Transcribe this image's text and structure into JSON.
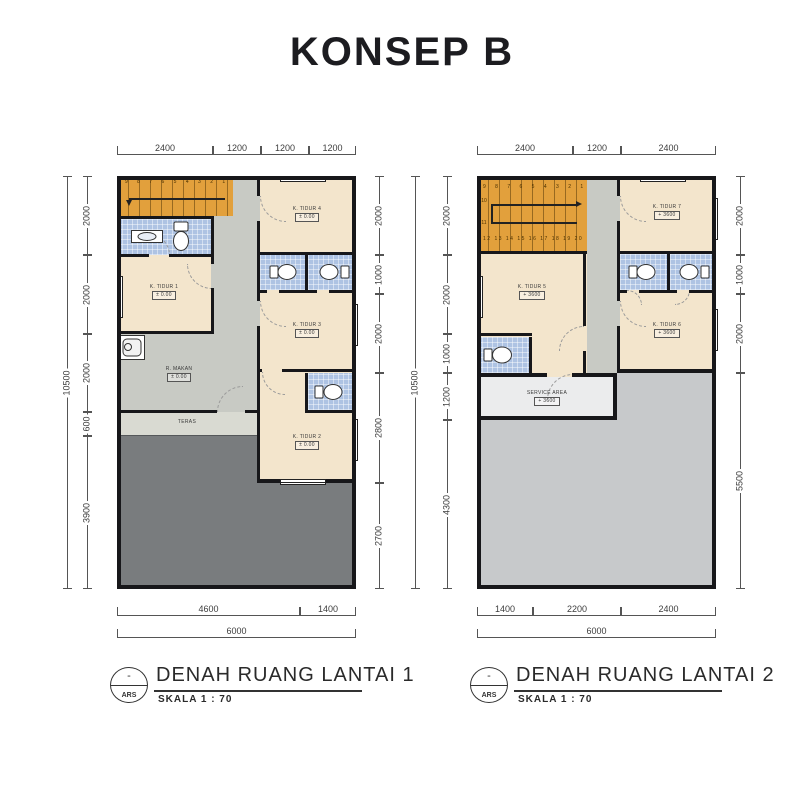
{
  "title": "KONSEP B",
  "colors": {
    "wall": "#17171a",
    "stair_orange": "#e2a03c",
    "bathroom_blue": "#aec3e3",
    "room_cream": "#f3e5cc",
    "corridor_grey": "#c8cac4",
    "teras_grey": "#d9dad2",
    "yard_dark_grey": "#797c7e",
    "roof_grey": "#c7c9cb",
    "service_white": "#ebeced"
  },
  "plans": [
    {
      "caption": {
        "title": "DENAH RUANG LANTAI 1",
        "scale": "SKALA 1 : 70",
        "tag_top": "-",
        "tag_bottom": "ARS"
      },
      "stair": {
        "numbers": "9 8 7 6 5 4 3 2 1"
      },
      "rooms": {
        "k_tidur_1": {
          "name": "K. TIDUR 1",
          "elev": "± 0.00"
        },
        "k_tidur_2": {
          "name": "K. TIDUR 2",
          "elev": "± 0.00"
        },
        "k_tidur_3": {
          "name": "K. TIDUR 3",
          "elev": "± 0.00"
        },
        "k_tidur_4": {
          "name": "K. TIDUR 4",
          "elev": "± 0.00"
        },
        "r_makan": {
          "name": "R. MAKAN",
          "elev": "± 0.00"
        },
        "teras": {
          "name": "TERAS"
        }
      },
      "dims": {
        "top": [
          "2400",
          "1200",
          "1200",
          "1200"
        ],
        "left_total": "10500",
        "left": [
          "2000",
          "2000",
          "2000",
          "600",
          "3900"
        ],
        "right": [
          "2000",
          "1000",
          "2000",
          "2800",
          "2700"
        ],
        "bottom": [
          "4600",
          "1400"
        ],
        "bottom_total": "6000"
      }
    },
    {
      "caption": {
        "title": "DENAH RUANG LANTAI 2",
        "scale": "SKALA 1 : 70",
        "tag_top": "-",
        "tag_bottom": "ARS"
      },
      "stair": {
        "numbers_upper": "9 8 7 6 5 4 3 2 1",
        "numbers_lower": "12 13 14 15 16 17 18 19 20",
        "landing_a": "10",
        "landing_b": "11"
      },
      "rooms": {
        "k_tidur_5": {
          "name": "K. TIDUR 5",
          "elev": "+ 3600"
        },
        "k_tidur_6": {
          "name": "K. TIDUR 6",
          "elev": "+ 3600"
        },
        "k_tidur_7": {
          "name": "K. TIDUR 7",
          "elev": "+ 3600"
        },
        "service": {
          "name": "SERVICE AREA",
          "elev": "+ 3600"
        }
      },
      "dims": {
        "top": [
          "2400",
          "1200",
          "2400"
        ],
        "left_total": "10500",
        "left": [
          "2000",
          "2000",
          "1000",
          "1200",
          "4300"
        ],
        "right": [
          "2000",
          "1000",
          "2000",
          "5500"
        ],
        "bottom": [
          "1400",
          "2200",
          "2400"
        ],
        "bottom_total": "6000"
      }
    }
  ]
}
